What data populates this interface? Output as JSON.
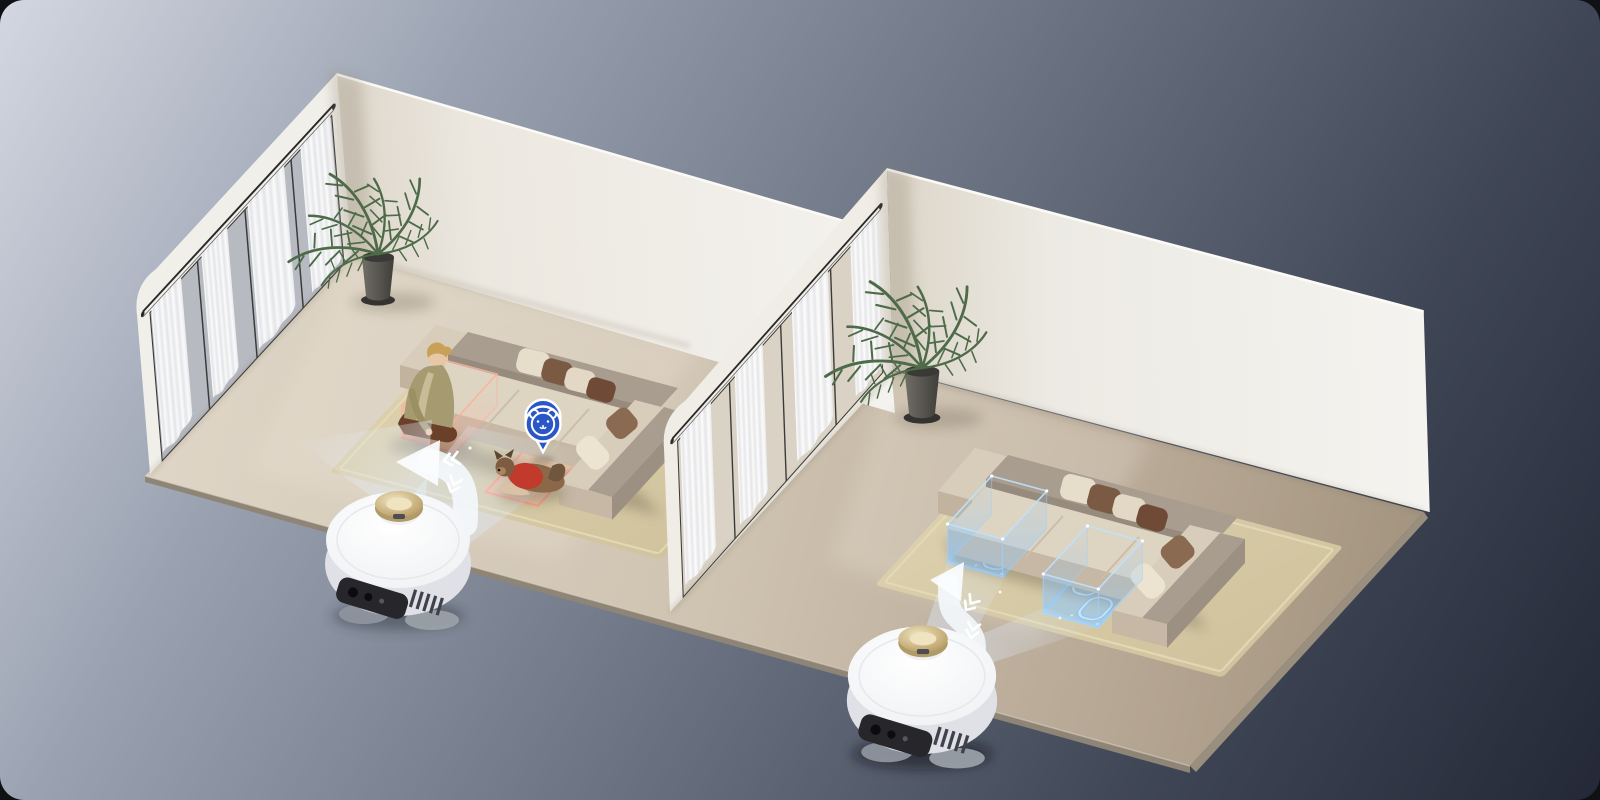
{
  "meta": {
    "type": "product-marketing-render",
    "subject": "Robot vacuum AI recognition scene: two isometric rooms",
    "canvas": {
      "width": 1600,
      "height": 800,
      "corner_radius": 24
    }
  },
  "background": {
    "gradient_stops": [
      "#d4d7e1",
      "#9aa2b1",
      "#3f4655",
      "#171b29"
    ]
  },
  "palette": {
    "floor": "#cfc3b1",
    "floor_edge": "#8f8577",
    "wall": "#f1eee8",
    "rug": "#d8cca9",
    "sofa_cream": "#ded4c2",
    "sofa_taupe": "#a89d8f",
    "pillow_brown": "#7b5a44",
    "accent_blue": "#2a57c5",
    "holo_blue": "#9ed4ff",
    "alert_pink": "#ffa18c",
    "gold": "#c9b584",
    "robot_white": "#f7f8fa",
    "beam": "#dceafe",
    "plant_green": "#4e6b49",
    "pet_sweater": "#c13a2c",
    "curtain_white": "#ffffff"
  },
  "icons": {
    "pet_pin": "pet-face-location-pin",
    "path_arrow_left_room": "turn-arrow-with-chevrons",
    "path_arrow_right_room": "s-curve-arrow-with-chevrons"
  },
  "left_room": {
    "label": "pet and human recognition room",
    "elements": [
      "window-wall-with-curtains",
      "right-wall",
      "palm-plant",
      "area-rug",
      "sectional-sofa",
      "seated-woman-reading",
      "book-detection-zone",
      "dog-in-red-sweater-detection-zone",
      "pet-location-pin",
      "robot-vacuum",
      "projection-beams"
    ]
  },
  "right_room": {
    "label": "carpet deep-clean zone room",
    "elements": [
      "window-wall-with-curtains",
      "right-wall",
      "palm-plant",
      "area-rug",
      "sectional-sofa",
      "holographic-clean-zone-a",
      "holographic-clean-zone-b",
      "robot-vacuum",
      "projection-beams"
    ]
  },
  "aria": {
    "scene": "Isometric render of two rooms: in the left room a robot vacuum detects a reading woman and a dog in a red sweater with pink highlight zones and a blue pet pin; in the right room the robot projects two glowing blue holographic cleaning zones on a carpet",
    "robot": "white robot vacuum with gold LiDAR turret",
    "pet_pin": "blue location pin with pet face icon"
  }
}
